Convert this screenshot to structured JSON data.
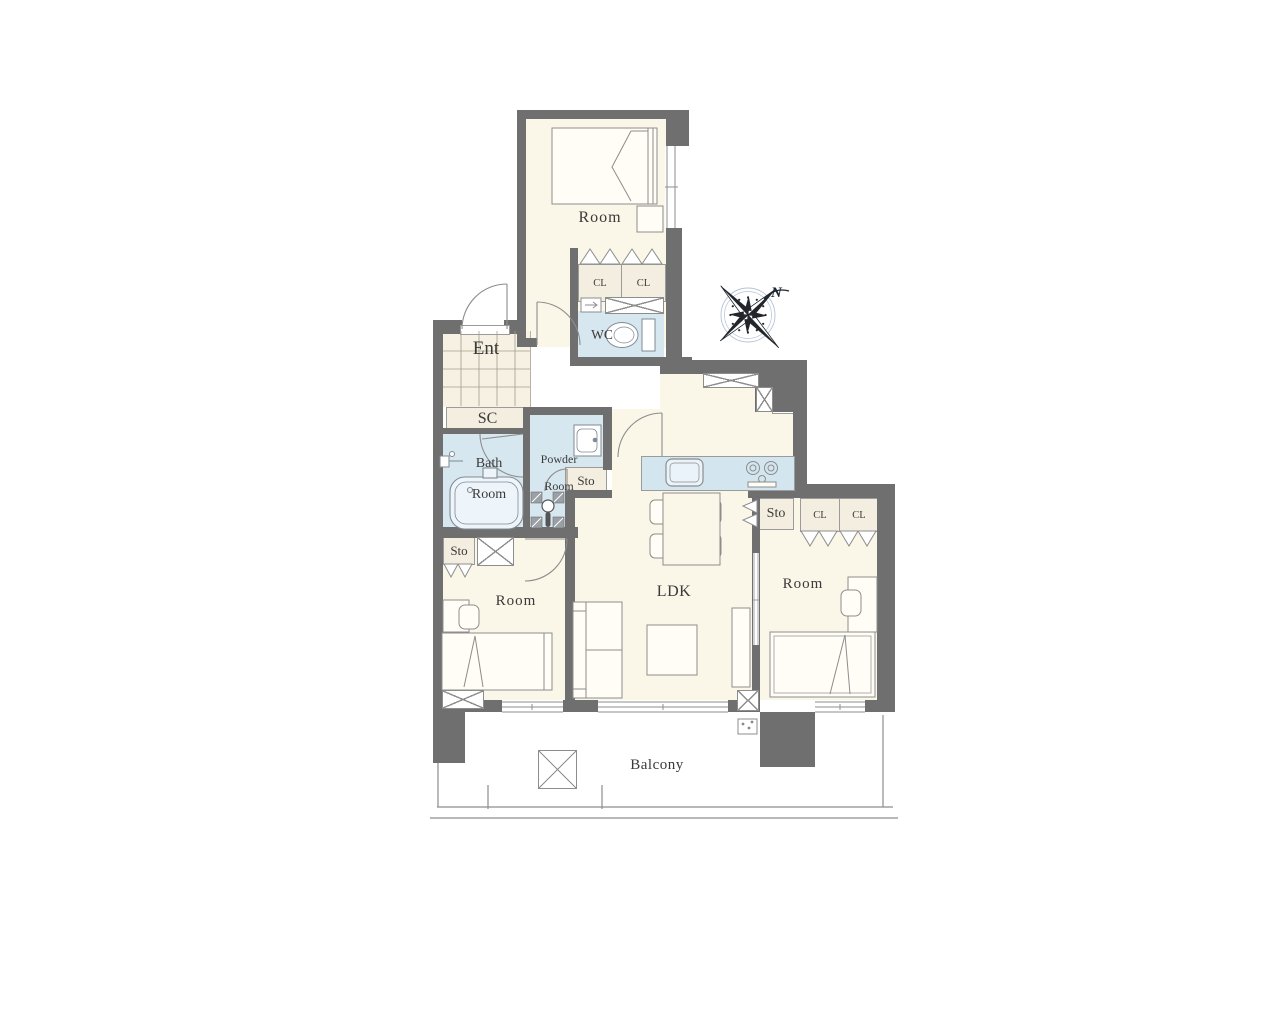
{
  "floorplan": {
    "type": "apartment-floor-plan",
    "compass": {
      "north_label": "N"
    },
    "labels": {
      "room_top": "Room",
      "room_left": "Room",
      "room_right": "Room",
      "ldk": "LDK",
      "balcony": "Balcony",
      "entrance": "Ent",
      "shoe_cabinet": "SC",
      "bath_line1": "Bath",
      "bath_line2": "Room",
      "powder_line1": "Powder",
      "powder_line2": "Room",
      "wc": "WC",
      "storage_powder": "Sto",
      "storage_room_left": "Sto",
      "storage_ldk": "Sto",
      "closet_top_left": "CL",
      "closet_top_right": "CL",
      "closet_right_1": "CL",
      "closet_right_2": "CL",
      "shelf": "shelf"
    },
    "colors": {
      "wall": "#6f6f6f",
      "room_floor": "#faf6e8",
      "wet_area": "#d7e7f0",
      "closet_fill": "#f4eee0",
      "tile_floor": "#f6f1e3",
      "outline": "#8d8d8d",
      "text": "#3a3a3a"
    }
  }
}
